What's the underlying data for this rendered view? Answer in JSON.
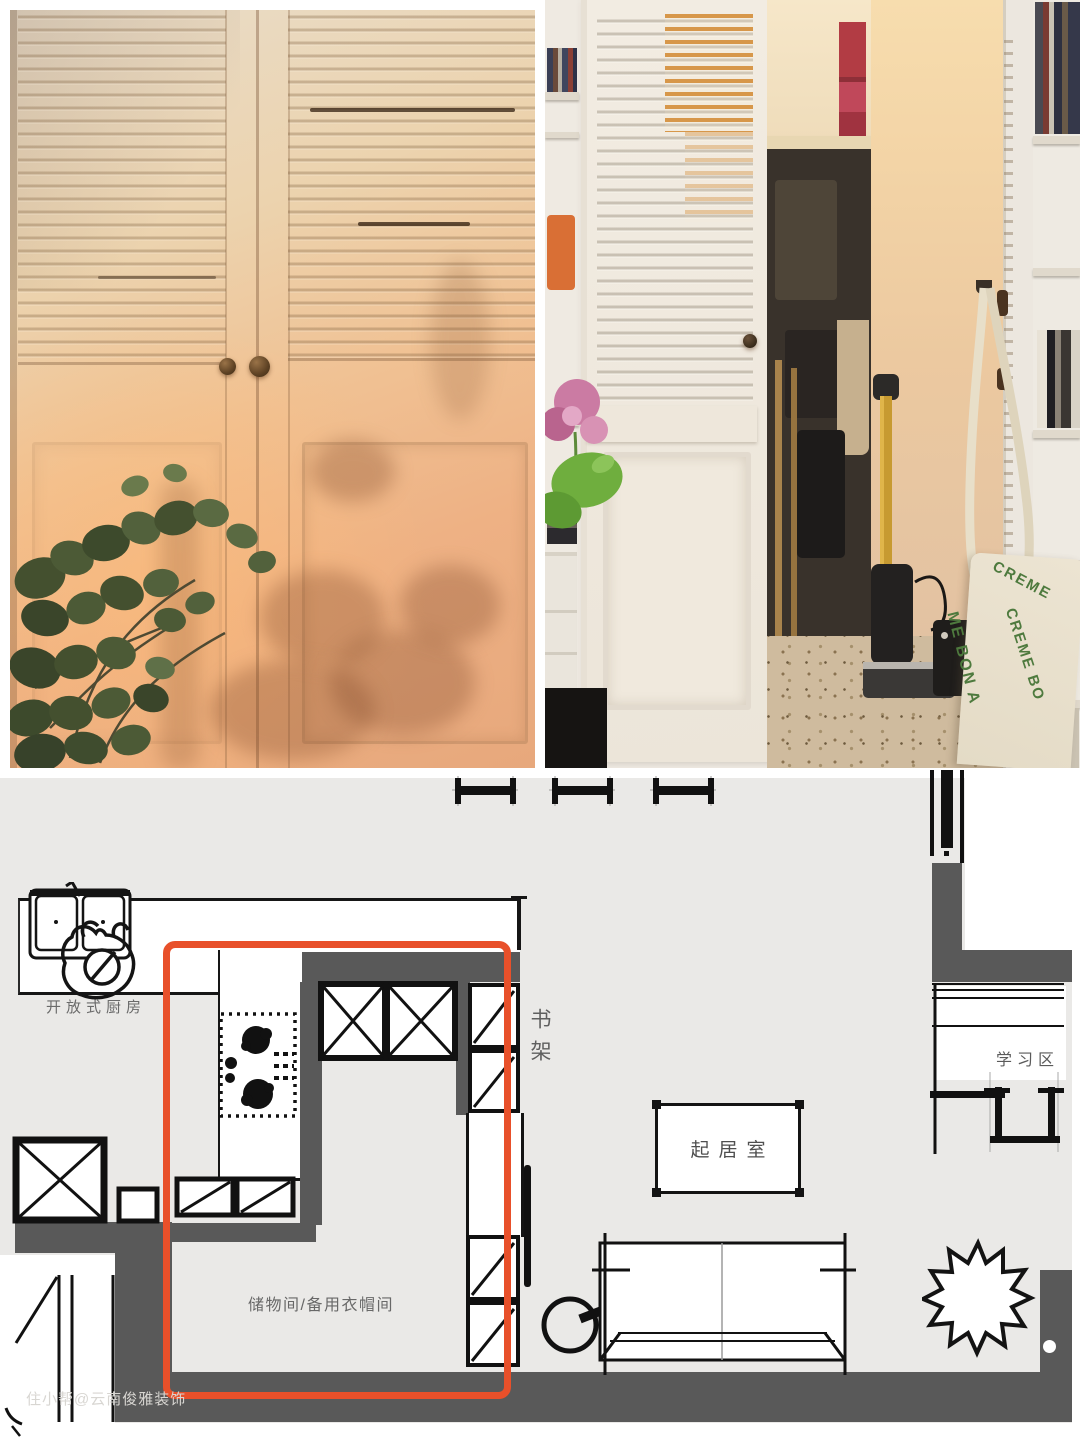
{
  "floorplan": {
    "labels": {
      "kitchen": "开放式厨房",
      "bookshelf": "书架",
      "living_room": "起居室",
      "study_area": "学习区",
      "storage_room": "储物间/备用衣帽间"
    },
    "watermark": "住小帮@云南俊雅装饰",
    "colors": {
      "highlight": "#E8502A",
      "wall": "#595959",
      "floor": "#EAE9E7",
      "line": "#161616"
    }
  },
  "photos": {
    "right": {
      "tote_bag_text": [
        "CREME",
        "CREME BO",
        "ME BON A"
      ]
    }
  }
}
